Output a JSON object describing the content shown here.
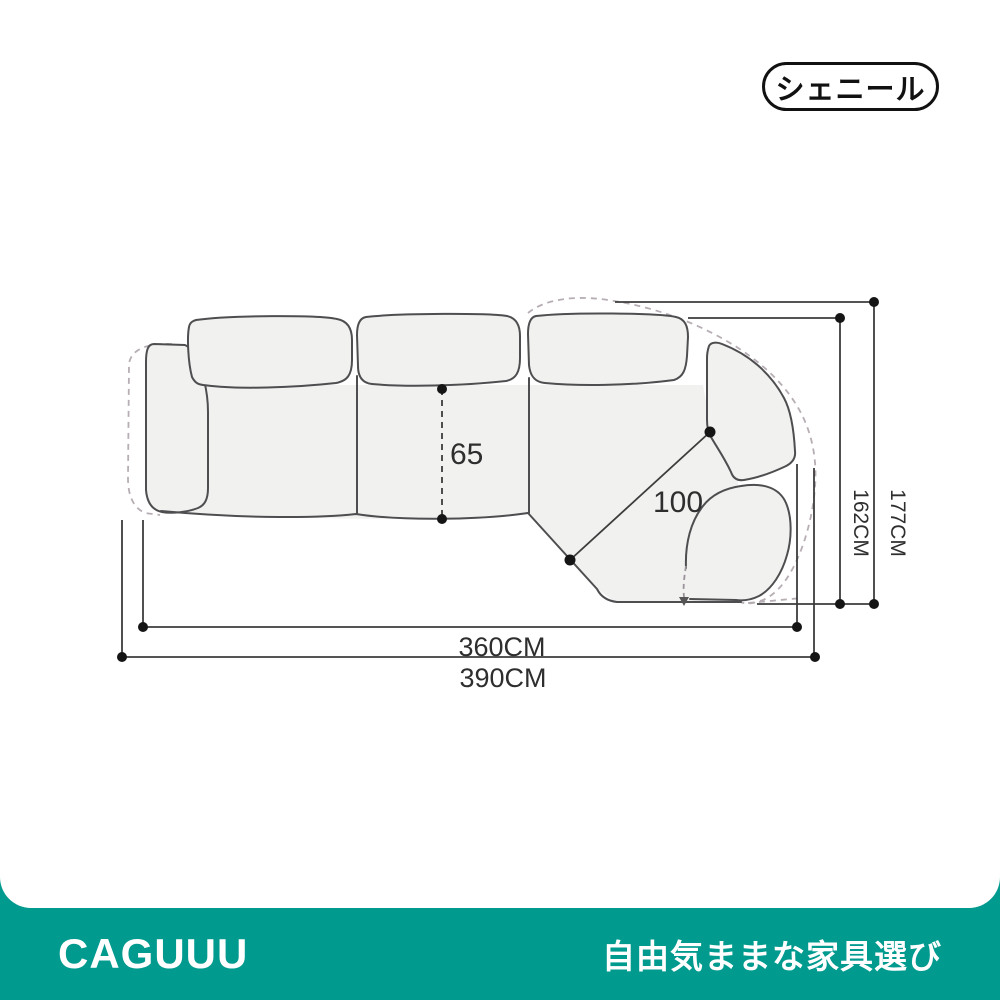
{
  "badge": {
    "label": "シェニール"
  },
  "diagram": {
    "labels": {
      "seat_width": "65",
      "corner_seat_width": "100",
      "depth_body": "162CM",
      "depth_total": "177CM",
      "width_body": "360CM",
      "width_total": "390CM"
    }
  },
  "footer": {
    "logo": "CAGUUU",
    "tagline": "自由気ままな家具選び"
  },
  "colors": {
    "accent_teal": "#009a8e",
    "sofa_line": "#4e4e50",
    "sofa_fill": "#f1f1f0",
    "ghost_dash": "#b6aeb4",
    "dimension_line": "#3c3c3c",
    "text": "#2e2e2e"
  }
}
